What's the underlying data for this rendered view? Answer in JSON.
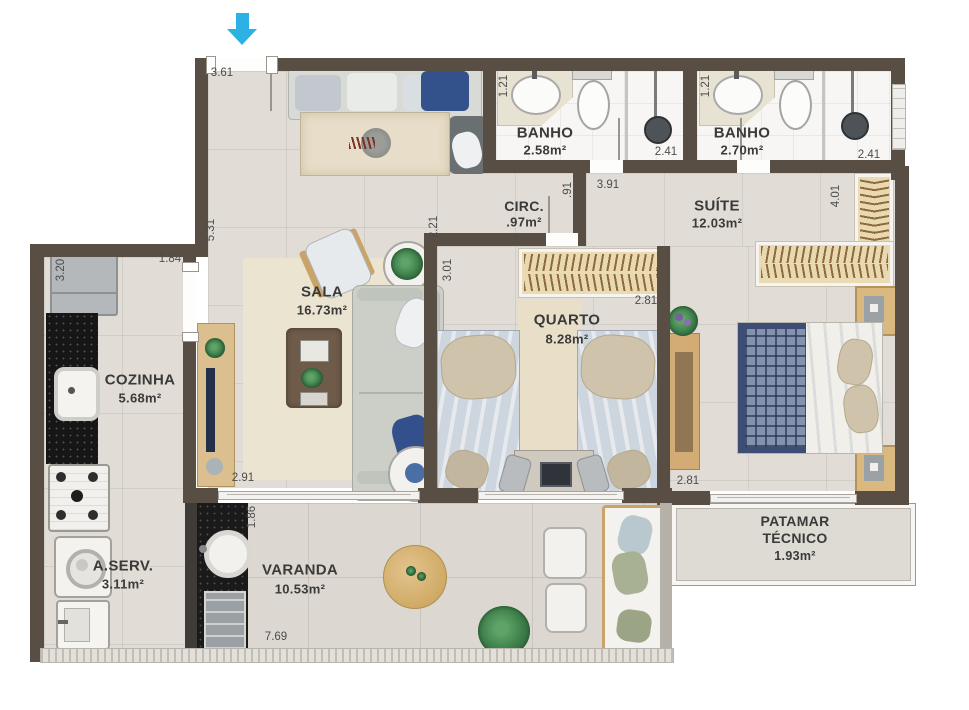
{
  "plan": {
    "type": "apartment-floor-plan",
    "wall_color": "#594e44",
    "entrance_arrow_color": "#2bb1e3"
  },
  "rooms": {
    "sala": {
      "name": "SALA",
      "area": "16.73m²"
    },
    "cozinha": {
      "name": "COZINHA",
      "area": "5.68m²"
    },
    "aserv": {
      "name": "A.SERV.",
      "area": "3.11m²"
    },
    "varanda": {
      "name": "VARANDA",
      "area": "10.53m²"
    },
    "quarto": {
      "name": "QUARTO",
      "area": "8.28m²"
    },
    "suite": {
      "name": "SUÍTE",
      "area": "12.03m²"
    },
    "circ": {
      "name": "CIRC.",
      "area": ".97m²"
    },
    "banho1": {
      "name": "BANHO",
      "area": "2.58m²"
    },
    "banho2": {
      "name": "BANHO",
      "area": "2.70m²"
    },
    "patamar": {
      "name_line1": "PATAMAR",
      "name_line2": "TÉCNICO",
      "area": "1.93m²"
    }
  },
  "dimensions": {
    "sala_top": "3.61",
    "sala_left": "5.31",
    "sala_right": "2.21",
    "sala_bottom": "2.91",
    "cozinha_top": "1.84",
    "cozinha_left": "3.20",
    "banho1_width": "1.21",
    "banho1_length": "2.41",
    "banho2_width": "1.21",
    "banho2_length": "2.41",
    "circ_width": ".91",
    "suite_width": "3.91",
    "suite_depth": "4.01",
    "suite_bed_width": "2.81",
    "quarto_depth": "3.01",
    "quarto_width": "2.81",
    "varanda_depth": "1.86",
    "varanda_width": "7.69"
  }
}
